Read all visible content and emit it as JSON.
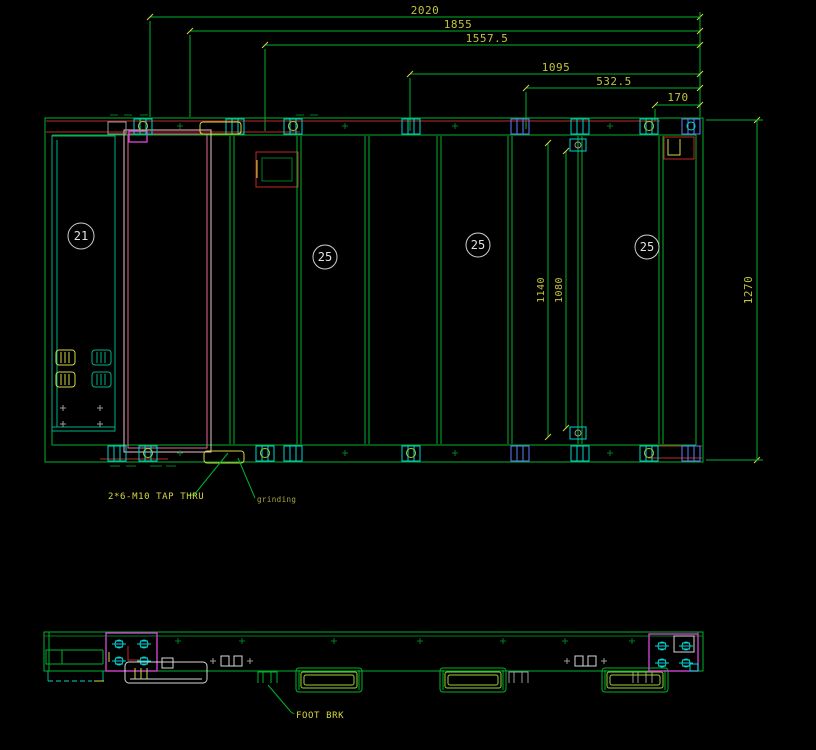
{
  "palette": {
    "background": "#000000",
    "line_green": "#00b32c",
    "teal": "#00b386",
    "cyan": "#00d4d4",
    "blue": "#5b7fff",
    "red": "#c22929",
    "magenta": "#cc44cc",
    "pink": "#e0679a",
    "yellow": "#d8d840",
    "white": "#d8d8d8",
    "dim_text": "#c3c33e",
    "balloon_text": "#e0e0e0",
    "callout_text": "#d8d840",
    "grinding_text": "#a8a848"
  },
  "dims": {
    "top": [
      "2020",
      "1855",
      "1557.5",
      "1095",
      "532.5",
      "170"
    ],
    "right": "1270",
    "inner": [
      "1140",
      "1080"
    ]
  },
  "balloons": [
    {
      "label": "21"
    },
    {
      "label": "25"
    },
    {
      "label": "25"
    },
    {
      "label": "25"
    }
  ],
  "callouts": {
    "tap_thru": "2*6-M10 TAP THRU",
    "grinding": "grinding",
    "foot_brk": "FOOT BRK"
  }
}
